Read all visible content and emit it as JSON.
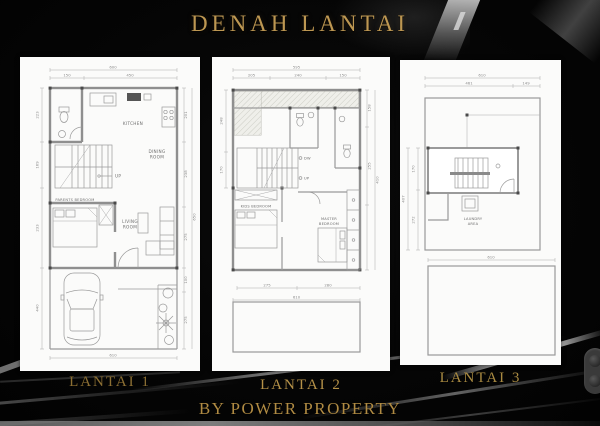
{
  "page": {
    "title": "DENAH LANTAI",
    "footer": "BY POWER PROPERTY",
    "colors": {
      "background": "#050505",
      "gold_title": "#bd9752",
      "gold_labels": "#a5813c",
      "panel": "#fbfbfa",
      "plan_lines": "#8f8f8f"
    }
  },
  "plans": [
    {
      "label": "LANTAI 1",
      "rooms": {
        "kitchen": "KITCHEN",
        "dining1": "DINING",
        "dining2": "ROOM",
        "up": "UP",
        "parents": "PARENTS BEDROOM",
        "living1": "LIVING",
        "living2": "ROOM"
      },
      "dims": {
        "top_total": "600",
        "top_segs": [
          "150",
          "450"
        ],
        "left": [
          "223",
          "169",
          "233",
          "440"
        ],
        "right": [
          "201",
          "238",
          "275",
          "100",
          "275"
        ],
        "right_total": "650",
        "bottom": "610"
      }
    },
    {
      "label": "LANTAI 2",
      "rooms": {
        "kids": "KIDS BEDROOM",
        "master1": "MASTER",
        "master2": "BEDROOM",
        "dw": "DW",
        "up": "UP"
      },
      "dims": {
        "top_total": "595",
        "top_segs": [
          "205",
          "240",
          "150"
        ],
        "left": [
          "248",
          "170"
        ],
        "right": [
          "158",
          "255"
        ],
        "right_total": "410",
        "mid": [
          "275",
          "280"
        ],
        "bottom": "610"
      }
    },
    {
      "label": "LANTAI 3",
      "rooms": {
        "laundry1": "LAUNDRY",
        "laundry2": "AREA"
      },
      "dims": {
        "top_total": "610",
        "top_segs": [
          "461",
          "149"
        ],
        "left_total": "407",
        "left": [
          "170",
          "272"
        ],
        "bottom": "610"
      }
    }
  ]
}
